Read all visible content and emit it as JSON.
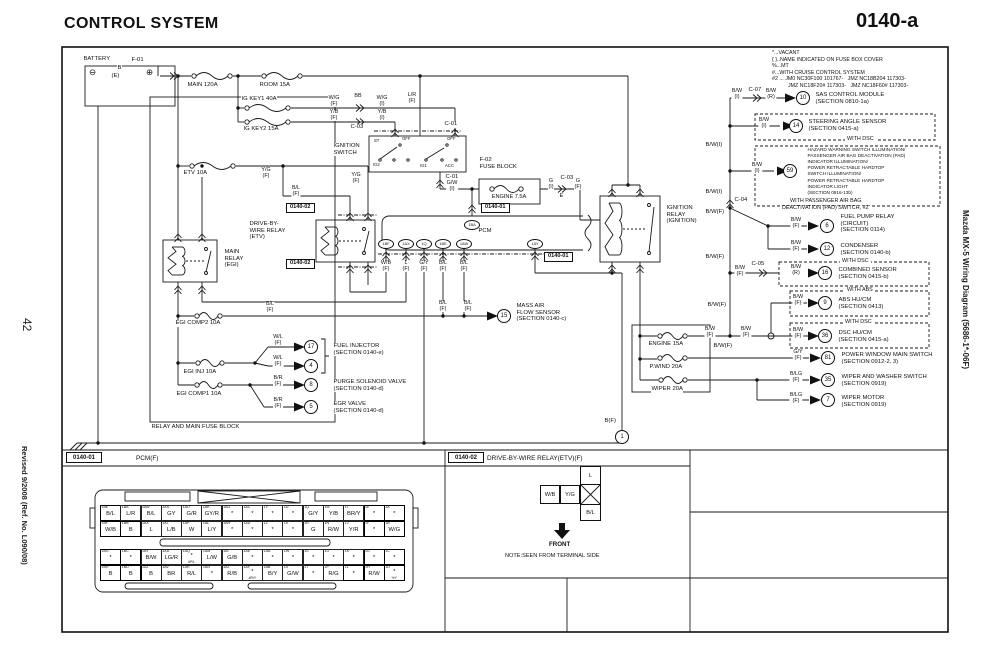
{
  "page": {
    "title": "CONTROL SYSTEM",
    "code": "0140-a",
    "page_number": "42",
    "revision": "Revised 9/2008 (Ref. No. L090/08)",
    "side_title": "Mazda MX-5 Wiring Diagram (5686-1*-06F)"
  },
  "legend": {
    "lines": [
      "*...VACANT",
      "{ }..NAME INDICATED ON FUSE BOX COVER",
      "%...MT",
      "#...WITH CRUISE CONTROL SYSTEM",
      "#2 ... JM0 NC30F100 101767-   JMZ NC18B204 117303-",
      "JMZ NC18F20# 117303-   JMZ NC18F60# 117303-"
    ]
  },
  "footer": {
    "left_ref": "0140-01",
    "left_name": "PCM(F)",
    "right_ref": "0140-02",
    "right_name": "DRIVE-BY-WIRE RELAY(ETV)(F)",
    "front_label": "FRONT",
    "note": "NOTE:SEEN FROM TERMINAL SIDE"
  },
  "dbw_connector": {
    "pins": [
      "W/B",
      "Y/G",
      "L",
      "B/L"
    ]
  },
  "pcm_connector": {
    "rows": [
      [
        [
          "1BE",
          "B/L",
          1
        ],
        [
          "1BA",
          "L/R",
          0
        ],
        [
          "1AW",
          "B/L",
          0
        ],
        [
          "1AS",
          "GY",
          0
        ],
        [
          "1AO",
          "G/R",
          0
        ],
        [
          "1AK",
          "GY/R",
          0
        ],
        [
          "1AG",
          "*",
          0
        ],
        [
          "1AC",
          "*",
          0
        ],
        [
          "1Y",
          "*",
          0
        ],
        [
          "1U",
          "*",
          0
        ],
        [
          "1Q",
          "G/Y",
          0
        ],
        [
          "1M",
          "Y/B",
          0
        ],
        [
          "1I",
          "BR/Y",
          0
        ],
        [
          "1E",
          "*",
          1
        ],
        [
          "1A",
          "*",
          1
        ]
      ],
      [
        [
          "1BF",
          "W/B",
          1
        ],
        [
          "1BB",
          "B",
          1
        ],
        [
          "1AX",
          "L",
          0
        ],
        [
          "1AT",
          "L/B",
          0
        ],
        [
          "1AP",
          "W",
          0
        ],
        [
          "1AL",
          "L/Y",
          0
        ],
        [
          "1AH",
          "*",
          0
        ],
        [
          "1AD",
          "*",
          0
        ],
        [
          "1Z",
          "*",
          0
        ],
        [
          "1V",
          "*",
          0
        ],
        [
          "1R",
          "G",
          0
        ],
        [
          "1N",
          "R/W",
          0
        ],
        [
          "1J",
          "Y/R",
          0
        ],
        [
          "1F",
          "*",
          1
        ],
        [
          "1B",
          "W/G",
          1
        ]
      ],
      [
        [
          "1BG",
          "*",
          1
        ],
        [
          "1BC",
          "*",
          1
        ],
        [
          "1AY",
          "B/W",
          0
        ],
        [
          "1AU",
          "LG/R",
          0
        ],
        [
          "1AQ",
          "*",
          0,
          "#P/L"
        ],
        [
          "1AM",
          "L/W",
          0
        ],
        [
          "1AI",
          "G/B",
          0
        ],
        [
          "1AE",
          "*",
          0
        ],
        [
          "1AA",
          "*",
          0
        ],
        [
          "1W",
          "*",
          0
        ],
        [
          "1S",
          "*",
          0
        ],
        [
          "1O",
          "*",
          0
        ],
        [
          "1K",
          "*",
          0
        ],
        [
          "1G",
          "*",
          1
        ],
        [
          "1C",
          "*",
          1
        ]
      ],
      [
        [
          "1BH",
          "B",
          1
        ],
        [
          "1BD",
          "B",
          1
        ],
        [
          "1AZ",
          "B",
          1
        ],
        [
          "1AV",
          "BR",
          0
        ],
        [
          "1AR",
          "R/L",
          0
        ],
        [
          "1AN",
          "*",
          0
        ],
        [
          "1AJ",
          "R/B",
          0
        ],
        [
          "1AF",
          "*",
          0,
          "#R/Y"
        ],
        [
          "1AB",
          "B/Y",
          0
        ],
        [
          "1X",
          "G/W",
          0
        ],
        [
          "1T",
          "*",
          0
        ],
        [
          "1P",
          "R/G",
          0
        ],
        [
          "1L",
          "*",
          1
        ],
        [
          "1H",
          "R/W",
          1
        ],
        [
          "1D",
          "*",
          1,
          "%Y"
        ]
      ]
    ]
  },
  "labels": [
    {
      "t": "BATTERY",
      "x": 83,
      "y": 56,
      "n": "battery-label"
    },
    {
      "t": "⊖",
      "x": 89,
      "y": 68,
      "c": "term",
      "n": "battery-minus-terminal"
    },
    {
      "t": "⊕",
      "x": 146,
      "y": 68,
      "c": "term",
      "n": "battery-plus-terminal"
    },
    {
      "t": "F-01",
      "x": 131,
      "y": 57,
      "n": "connector-f01"
    },
    {
      "t": "B",
      "x": 117,
      "y": 65
    },
    {
      "t": "(E)",
      "x": 111,
      "y": 73
    },
    {
      "t": "MAIN 120A",
      "x": 187,
      "y": 82,
      "n": "fuse-main-120a"
    },
    {
      "t": "ROOM 15A",
      "x": 259,
      "y": 82,
      "n": "fuse-room-15a"
    },
    {
      "t": "IG KEY1 40A",
      "x": 241,
      "y": 96,
      "n": "fuse-ig-key1-40a"
    },
    {
      "t": "IG KEY2 15A",
      "x": 243,
      "y": 126,
      "n": "fuse-ig-key2-15a"
    },
    {
      "t": "W/G\n(F)",
      "x": 334,
      "y": 96,
      "c": "w"
    },
    {
      "t": "BB",
      "x": 358,
      "y": 94,
      "c": "w"
    },
    {
      "t": "W/G\n(I)",
      "x": 382,
      "y": 96,
      "c": "w"
    },
    {
      "t": "Y/B\n(F)",
      "x": 334,
      "y": 110,
      "c": "w"
    },
    {
      "t": "Y/B\n(I)",
      "x": 382,
      "y": 110,
      "c": "w"
    },
    {
      "t": "C-03",
      "x": 350,
      "y": 124,
      "n": "connector-c03"
    },
    {
      "t": "L/R\n(F)",
      "x": 412,
      "y": 93,
      "c": "w"
    },
    {
      "t": "C-01",
      "x": 444,
      "y": 121,
      "n": "connector-c01"
    },
    {
      "t": "IGNITION\nSWITCH",
      "x": 333,
      "y": 143,
      "n": "ignition-switch-label"
    },
    {
      "t": "ST",
      "x": 374,
      "y": 139,
      "c": "tiny"
    },
    {
      "t": "OFF",
      "x": 402,
      "y": 137,
      "c": "tiny"
    },
    {
      "t": "OFF",
      "x": 447,
      "y": 137,
      "c": "tiny"
    },
    {
      "t": "IG2",
      "x": 373,
      "y": 163,
      "c": "tiny"
    },
    {
      "t": "IG1",
      "x": 420,
      "y": 164,
      "c": "tiny"
    },
    {
      "t": "ACC",
      "x": 445,
      "y": 164,
      "c": "tiny"
    },
    {
      "t": "ETV 10A",
      "x": 183,
      "y": 170,
      "n": "fuse-etv-10a"
    },
    {
      "t": "Y/G\n(F)",
      "x": 266,
      "y": 168,
      "c": "w"
    },
    {
      "t": "Y/G\n(F)",
      "x": 356,
      "y": 173,
      "c": "w"
    },
    {
      "t": "B/L\n(F)",
      "x": 296,
      "y": 186,
      "c": "w"
    },
    {
      "t": "C-01",
      "x": 445,
      "y": 174
    },
    {
      "t": "G/W\n(I)",
      "x": 452,
      "y": 181,
      "c": "w"
    },
    {
      "t": "F-02\nFUSE BLOCK",
      "x": 479,
      "y": 157,
      "n": "fuse-block-f02-label"
    },
    {
      "t": "ENGINE 7.5A",
      "x": 509,
      "y": 194,
      "c": "cen",
      "n": "fuse-engine-7-5a"
    },
    {
      "t": "G\n(I)",
      "x": 551,
      "y": 179,
      "c": "w"
    },
    {
      "t": "C-03",
      "x": 560,
      "y": 175
    },
    {
      "t": "E",
      "x": 559,
      "y": 193
    },
    {
      "t": "G\n(F)",
      "x": 578,
      "y": 179,
      "c": "w"
    },
    {
      "t": "0140-01",
      "x": 481,
      "y": 203,
      "c": "ref",
      "n": "ref-0140-01"
    },
    {
      "t": "PCM",
      "x": 478,
      "y": 228,
      "n": "pcm-label"
    },
    {
      "t": "0140-01",
      "x": 544,
      "y": 252,
      "c": "ref",
      "n": "ref-0140-01"
    },
    {
      "t": "0140-02",
      "x": 286,
      "y": 203,
      "c": "ref",
      "n": "ref-0140-02"
    },
    {
      "t": "0140-02",
      "x": 286,
      "y": 259,
      "c": "ref",
      "n": "ref-0140-02"
    },
    {
      "t": "DRIVE-BY-\nWIRE RELAY\n(ETV)",
      "x": 249,
      "y": 221,
      "n": "drive-by-wire-relay-label"
    },
    {
      "t": "MAIN\nRELAY\n(EGI)",
      "x": 224,
      "y": 249,
      "n": "main-relay-label"
    },
    {
      "t": "IGNITION\nRELAY\n(IGNITION)",
      "x": 666,
      "y": 205,
      "n": "ignition-relay-label"
    },
    {
      "t": "1BA",
      "x": 472,
      "y": 225,
      "c": "pin"
    },
    {
      "t": "1BF",
      "x": 386,
      "y": 244,
      "c": "pin"
    },
    {
      "t": "1AX",
      "x": 406,
      "y": 244,
      "c": "pin"
    },
    {
      "t": "1Q",
      "x": 424,
      "y": 244,
      "c": "pin"
    },
    {
      "t": "1BE",
      "x": 443,
      "y": 244,
      "c": "pin"
    },
    {
      "t": "1AW",
      "x": 464,
      "y": 244,
      "c": "pin"
    },
    {
      "t": "1AY",
      "x": 535,
      "y": 244,
      "c": "pin"
    },
    {
      "t": "W/B\n(F)",
      "x": 386,
      "y": 261,
      "c": "w"
    },
    {
      "t": "L\n(F)",
      "x": 406,
      "y": 261,
      "c": "w"
    },
    {
      "t": "G/Y\n(F)",
      "x": 424,
      "y": 261,
      "c": "w"
    },
    {
      "t": "B/L\n(F)",
      "x": 443,
      "y": 261,
      "c": "w"
    },
    {
      "t": "B/L\n(F)",
      "x": 464,
      "y": 261,
      "c": "w"
    },
    {
      "t": "MASS AIR\nFLOW SENSOR\n(SECTION  0140-c)",
      "x": 516,
      "y": 303,
      "n": "mass-air-flow-sensor"
    },
    {
      "t": "B/L\n(F)",
      "x": 443,
      "y": 301,
      "c": "w"
    },
    {
      "t": "B/L\n(F)",
      "x": 468,
      "y": 301,
      "c": "w"
    },
    {
      "t": "B/L\n(F)",
      "x": 270,
      "y": 302,
      "c": "w"
    },
    {
      "t": "EGI COMP2 10A",
      "x": 175,
      "y": 320,
      "n": "fuse-egi-comp2-10a"
    },
    {
      "t": "W/L\n(F)",
      "x": 278,
      "y": 335,
      "c": "w"
    },
    {
      "t": "W/L\n(F)",
      "x": 278,
      "y": 356,
      "c": "w"
    },
    {
      "t": "FUEL INJECTOR\n(SECTION 0140-e)",
      "x": 333,
      "y": 343,
      "n": "fuel-injector"
    },
    {
      "t": "EGI INJ 10A",
      "x": 183,
      "y": 369,
      "n": "fuse-egi-inj-10a"
    },
    {
      "t": "B/R\n(F)",
      "x": 278,
      "y": 376,
      "c": "w"
    },
    {
      "t": "PURGE SOLENOID VALVE\n(SECTION 0140-d)",
      "x": 333,
      "y": 379,
      "n": "purge-solenoid-valve"
    },
    {
      "t": "B/R\n(F)",
      "x": 278,
      "y": 398,
      "c": "w"
    },
    {
      "t": "EGR VALVE\n(SECTION 0140-d)",
      "x": 333,
      "y": 401,
      "n": "egr-valve"
    },
    {
      "t": "EGI COMP1 10A",
      "x": 176,
      "y": 391,
      "n": "fuse-egi-comp1-10a"
    },
    {
      "t": "RELAY AND MAIN FUSE BLOCK",
      "x": 151,
      "y": 424,
      "n": "relay-main-fuse-block-label"
    },
    {
      "t": "ENGINE 15A",
      "x": 648,
      "y": 341,
      "n": "fuse-engine-15a"
    },
    {
      "t": "P.WIND 20A",
      "x": 649,
      "y": 364,
      "n": "fuse-pwind-20a"
    },
    {
      "t": "WIPER 20A",
      "x": 651,
      "y": 386,
      "n": "fuse-wiper-20a"
    },
    {
      "t": "B(F)",
      "x": 604,
      "y": 418
    },
    {
      "t": "1",
      "x": 622,
      "y": 437,
      "c": "circ",
      "n": "ground-point-1"
    },
    {
      "t": "B/W\n(I)",
      "x": 737,
      "y": 89,
      "c": "w"
    },
    {
      "t": "C-07",
      "x": 748,
      "y": 87,
      "n": "connector-c07"
    },
    {
      "t": "B/W\n(R)",
      "x": 771,
      "y": 89,
      "c": "w"
    },
    {
      "t": "10",
      "x": 803,
      "y": 98,
      "c": "circ"
    },
    {
      "t": "SAS CONTROL MODULE\n(SECTION 0810-1a)",
      "x": 815,
      "y": 92,
      "n": "sas-control-module"
    },
    {
      "t": "B/W\n(I)",
      "x": 764,
      "y": 118,
      "c": "w"
    },
    {
      "t": "14",
      "x": 796,
      "y": 126,
      "c": "circ"
    },
    {
      "t": "STEERING ANGLE SENSOR\n(SECTION 0415-a)",
      "x": 808,
      "y": 119,
      "n": "steering-angle-sensor"
    },
    {
      "t": "WITH DSC",
      "x": 845,
      "y": 137,
      "c": "ond"
    },
    {
      "t": "B/W(I)",
      "x": 705,
      "y": 142
    },
    {
      "t": "B/W\n(I)",
      "x": 757,
      "y": 163,
      "c": "w"
    },
    {
      "t": "59",
      "x": 790,
      "y": 171,
      "c": "circ"
    },
    {
      "t": "HAZARD WARNING SWITCH ILLUMINATION/\nPASSENGER AIR BAG DEACTIVATION (PAD)\nINDICATOR ILLUMINATION/\nPOWER RETRACTABLE HARDTOP\nSWITCH ILLUMINATION/\nPOWER RETRACTABLE HARDTOP\nINDICATOR LIGHT\n(SECTION 0916-13b)",
      "x": 807,
      "y": 147,
      "c": "t8",
      "n": "hardtop-pad-illumination"
    },
    {
      "t": "WITH PASSENGER AIR BAG",
      "x": 788,
      "y": 199,
      "c": "ond"
    },
    {
      "t": "DEACTIVATION (PAD) SWITCH, #2",
      "x": 780,
      "y": 206,
      "c": "ond"
    },
    {
      "t": "B/W(I)",
      "x": 705,
      "y": 189
    },
    {
      "t": "C-04",
      "x": 734,
      "y": 197,
      "n": "connector-c04"
    },
    {
      "t": "B/W(F)",
      "x": 705,
      "y": 209
    },
    {
      "t": "B/W\n(F)",
      "x": 796,
      "y": 218,
      "c": "w"
    },
    {
      "t": "6",
      "x": 827,
      "y": 226,
      "c": "circ"
    },
    {
      "t": "FUEL PUMP RELAY\n(CIRCUIT)\n(SECTION 0114)",
      "x": 840,
      "y": 214,
      "n": "fuel-pump-relay"
    },
    {
      "t": "B/W\n(F)",
      "x": 796,
      "y": 241,
      "c": "w"
    },
    {
      "t": "12",
      "x": 827,
      "y": 249,
      "c": "circ"
    },
    {
      "t": "CONDENSER\n(SECTION 0140-b)",
      "x": 840,
      "y": 243,
      "n": "condenser"
    },
    {
      "t": "B/W(F)",
      "x": 705,
      "y": 254
    },
    {
      "t": "C-05",
      "x": 751,
      "y": 261,
      "n": "connector-c05"
    },
    {
      "t": "B/W\n(F)",
      "x": 740,
      "y": 266,
      "c": "w"
    },
    {
      "t": "WITH DSC",
      "x": 840,
      "y": 259,
      "c": "ond"
    },
    {
      "t": "B/W\n(R)",
      "x": 796,
      "y": 265,
      "c": "w"
    },
    {
      "t": "16",
      "x": 825,
      "y": 273,
      "c": "circ"
    },
    {
      "t": "COMBINED SENSOR\n(SECTION 0415-b)",
      "x": 838,
      "y": 267,
      "n": "combined-sensor"
    },
    {
      "t": "B/W(F)",
      "x": 707,
      "y": 302
    },
    {
      "t": "WITH ABS",
      "x": 845,
      "y": 288,
      "c": "ond"
    },
    {
      "t": "B/W\n(F)",
      "x": 798,
      "y": 295,
      "c": "w"
    },
    {
      "t": "9",
      "x": 825,
      "y": 303,
      "c": "circ"
    },
    {
      "t": "ABS HU/CM\n(SECTION 0413)",
      "x": 838,
      "y": 297,
      "n": "abs-hu-cm"
    },
    {
      "t": "WITH DSC",
      "x": 843,
      "y": 320,
      "c": "ond"
    },
    {
      "t": "B/W\n(F)",
      "x": 798,
      "y": 328,
      "c": "w"
    },
    {
      "t": "36",
      "x": 825,
      "y": 336,
      "c": "circ"
    },
    {
      "t": "DSC HU/CM\n(SECTION 0415-a)",
      "x": 838,
      "y": 330,
      "n": "dsc-hu-cm"
    },
    {
      "t": "B/W\n(F)",
      "x": 710,
      "y": 327,
      "c": "w"
    },
    {
      "t": "B/W\n(F)",
      "x": 746,
      "y": 327,
      "c": "w"
    },
    {
      "t": "B/W(F)",
      "x": 713,
      "y": 343
    },
    {
      "t": "G/Y\n(F)",
      "x": 798,
      "y": 350,
      "c": "w"
    },
    {
      "t": "81",
      "x": 828,
      "y": 358,
      "c": "circ"
    },
    {
      "t": "POWER WINDOW MAIN SWITCH\n(SECTION 0912-2, 3)",
      "x": 841,
      "y": 352,
      "n": "power-window-main-switch"
    },
    {
      "t": "B/LG\n(F)",
      "x": 796,
      "y": 372,
      "c": "w"
    },
    {
      "t": "35",
      "x": 828,
      "y": 380,
      "c": "circ"
    },
    {
      "t": "WIPER AND WASHER SWITCH\n(SECTION 0919)",
      "x": 841,
      "y": 374,
      "n": "wiper-and-washer-switch"
    },
    {
      "t": "B/LG\n(F)",
      "x": 796,
      "y": 393,
      "c": "w"
    },
    {
      "t": "7",
      "x": 828,
      "y": 400,
      "c": "circ"
    },
    {
      "t": "WIPER MOTOR\n(SECTION 0919)",
      "x": 841,
      "y": 395,
      "n": "wiper-motor"
    },
    {
      "t": "15",
      "x": 504,
      "y": 316,
      "c": "circ"
    },
    {
      "t": "17",
      "x": 311,
      "y": 347,
      "c": "circ"
    },
    {
      "t": "4",
      "x": 311,
      "y": 366,
      "c": "circ"
    },
    {
      "t": "8",
      "x": 311,
      "y": 385,
      "c": "circ"
    },
    {
      "t": "5",
      "x": 311,
      "y": 407,
      "c": "circ"
    }
  ]
}
